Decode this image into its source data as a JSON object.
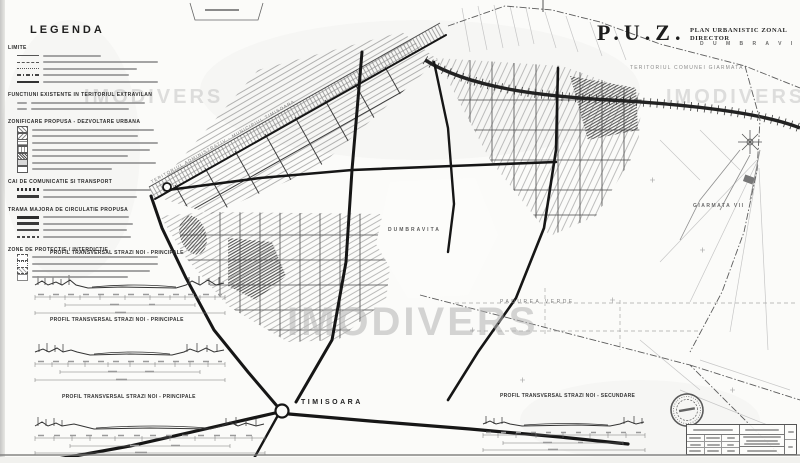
{
  "colors": {
    "ink": "#2a2a2a",
    "paper": "#fbfbf9",
    "watermark": "#b2b2b2"
  },
  "watermark": {
    "text": "IMODIVERS"
  },
  "legend": {
    "title": "LEGENDA",
    "sections": [
      {
        "heading": "LIMITE"
      },
      {
        "heading": "FUNCTIUNI EXISTENTE IN TERITORIUL EXTRAVILAN"
      },
      {
        "heading": "ZONIFICARE PROPUSA - DEZVOLTARE URBANA"
      },
      {
        "heading": "CAI DE COMUNICATIE SI TRANSPORT"
      },
      {
        "heading": "TRAMA MAJORA DE CIRCULATIE PROPUSA"
      },
      {
        "heading": "ZONE DE PROTECTIE / INTERDICTIE"
      }
    ]
  },
  "header": {
    "acronym": "P.U.Z.",
    "title": "PLAN URBANISTIC ZONAL DIRECTOR",
    "locality": "D U M B R A V I T A"
  },
  "map_labels": {
    "admin_band": "TERITORIUL ADMINISTRATIV - MUNICIPIUL TIMISOARA",
    "giarmata_territory": "TERITORIUL COMUNEI GIARMATA",
    "dumbravita": "DUMBRAVITA",
    "giarmata_vii": "GIARMATA VII",
    "padurea_verde": "PADUREA VERDE",
    "timisoara": "TIMISOARA"
  },
  "profiles": {
    "p1": "PROFIL TRANSVERSAL STRAZI NOI - PRINCIPALE",
    "p2": "PROFIL TRANSVERSAL STRAZI NOI - PRINCIPALE",
    "p3": "PROFIL TRANSVERSAL STRAZI NOI - PRINCIPALE",
    "p4": "PROFIL TRANSVERSAL STRAZI NOI - SECUNDARE"
  }
}
